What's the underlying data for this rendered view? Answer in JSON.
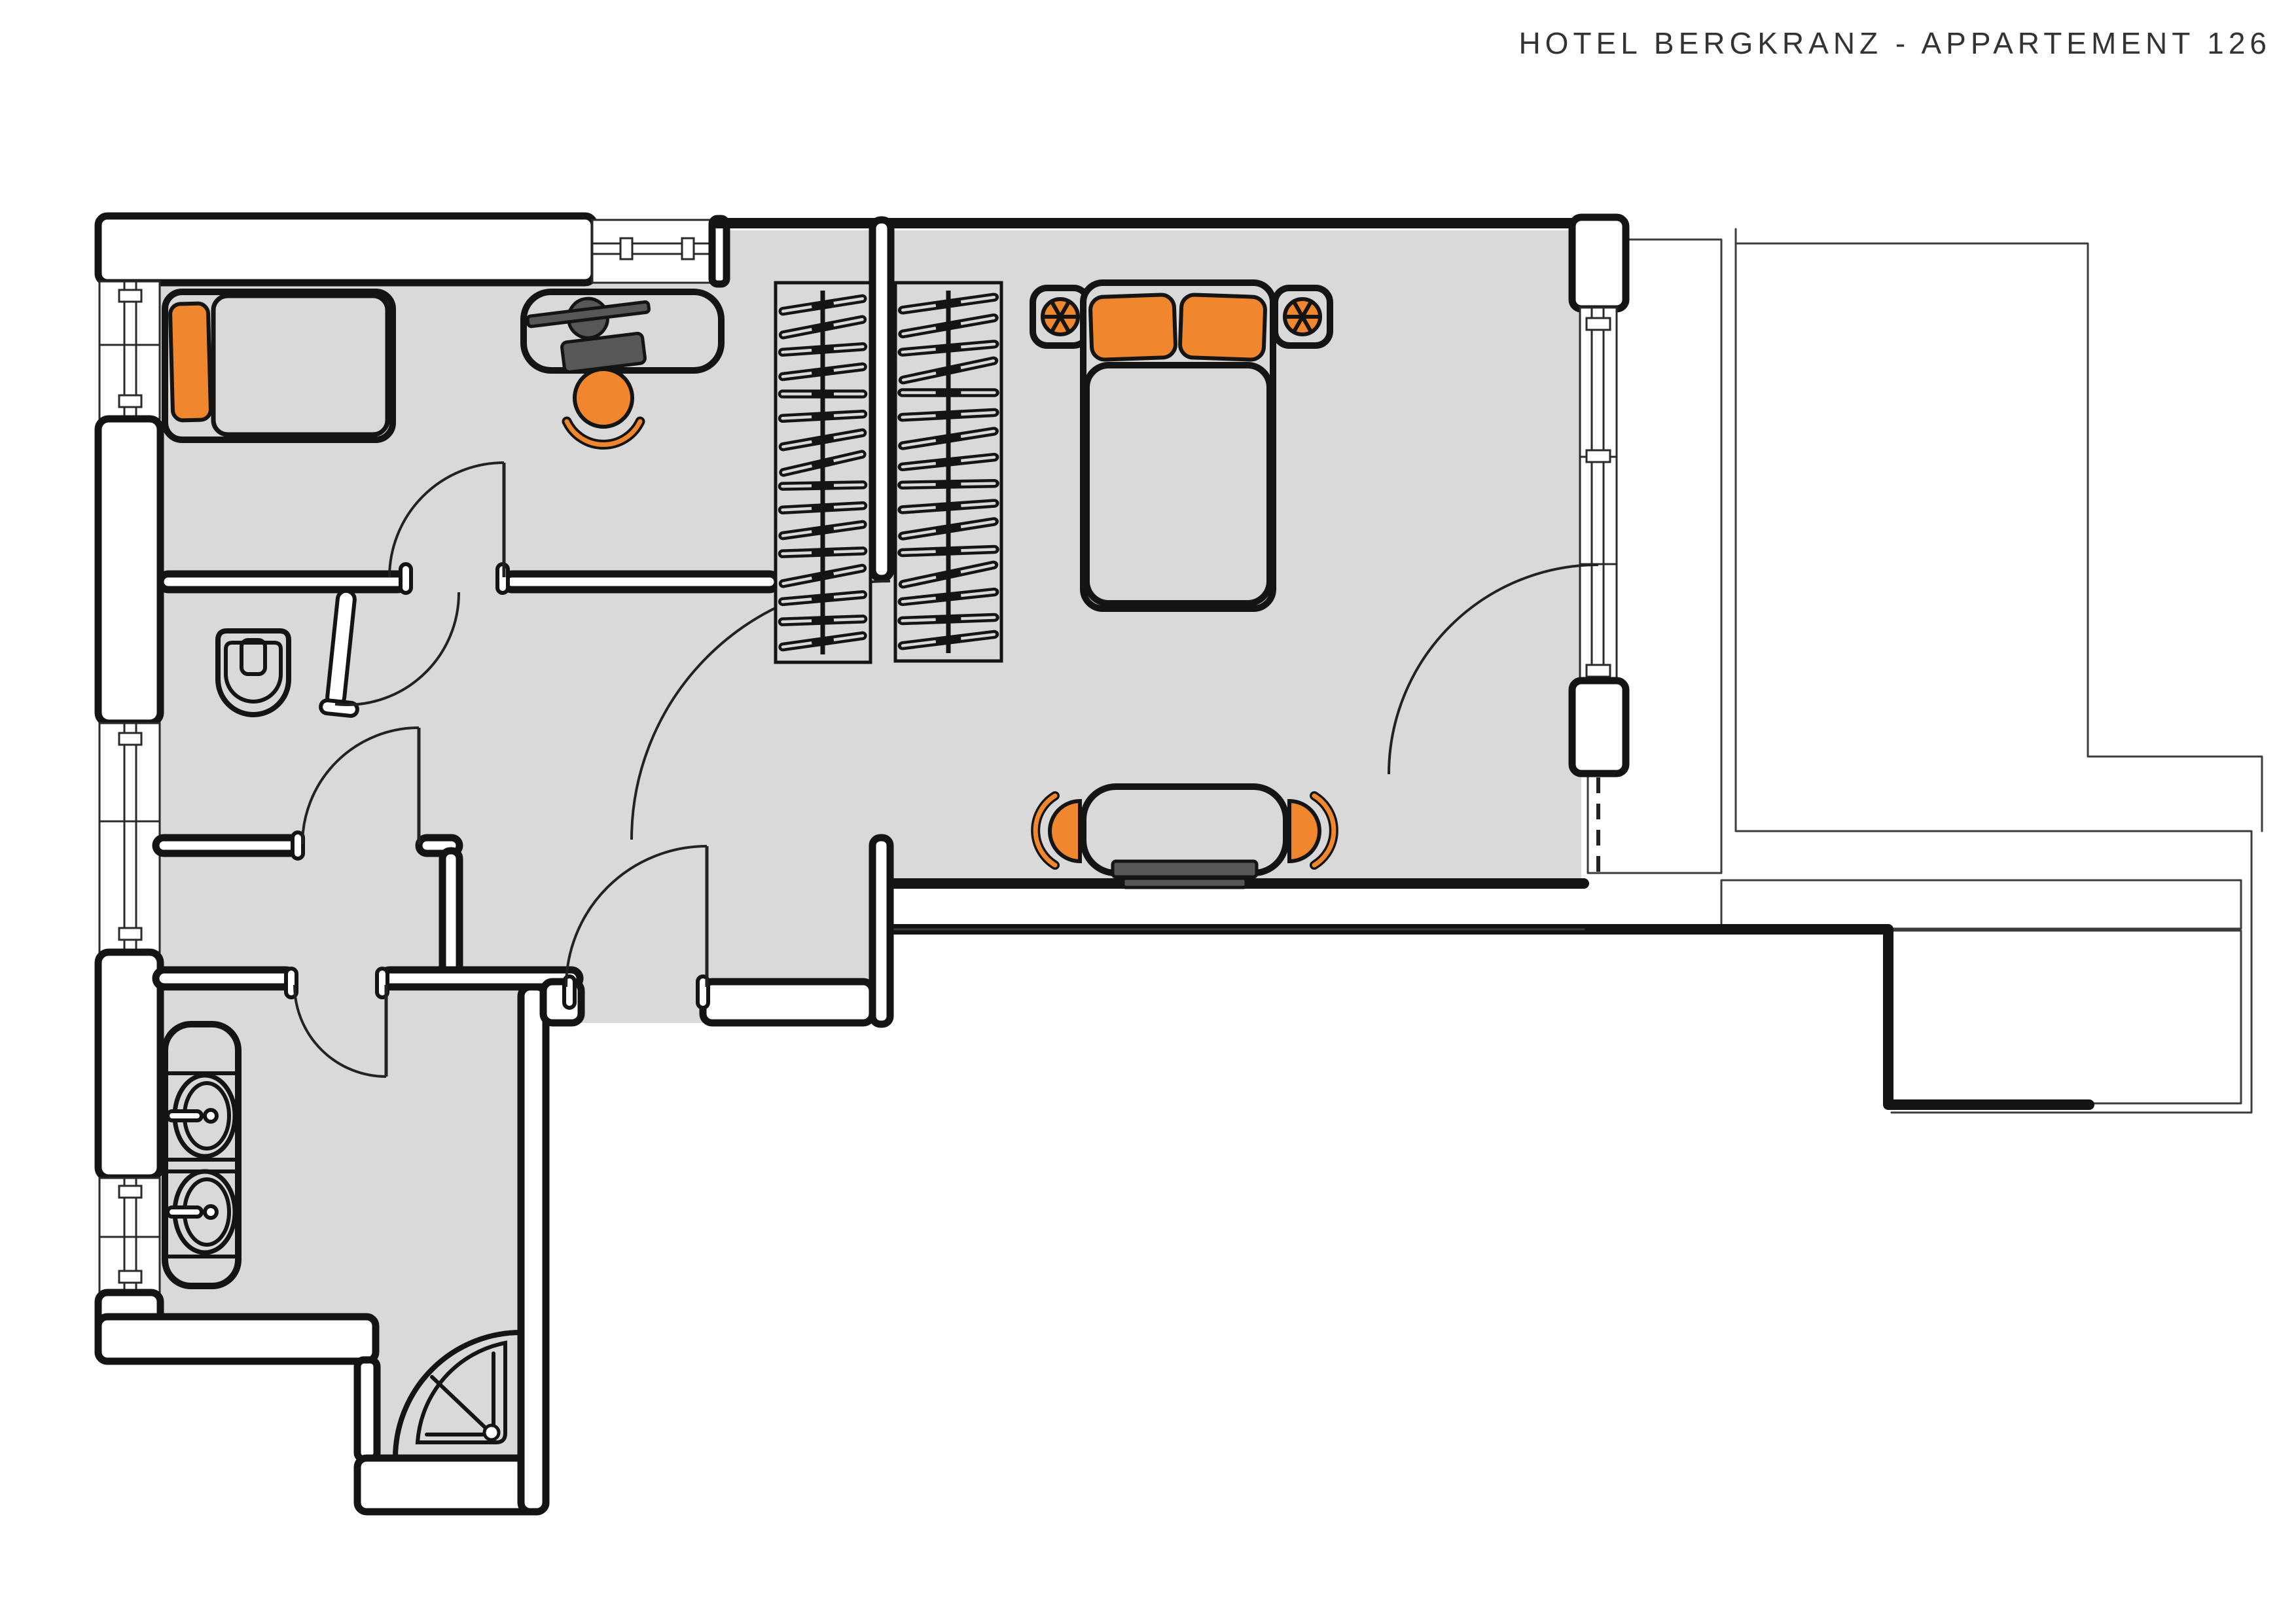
{
  "title": "HOTEL BERGKRANZ - APPARTEMENT 126",
  "colors": {
    "accent": "#F0862E",
    "floor": "#D9D9D9",
    "wall": "#FFFFFF",
    "line": "#141414",
    "dark": "#565759",
    "deck": "#8D8D8D"
  },
  "symbols": [
    "single-bed",
    "orange-pillow",
    "desk",
    "tv-on-desk",
    "desk-chair",
    "wardrobe-hangers-left",
    "wardrobe-hangers-right",
    "double-bed",
    "double-bed-pillows",
    "nightstand-left",
    "nightstand-right",
    "bedside-lamp-left",
    "bedside-lamp-right",
    "dining-table",
    "dining-chair-left",
    "dining-chair-right",
    "radiator",
    "toilet",
    "washbasin-top",
    "washbasin-bottom",
    "vanity-counter",
    "corner-shower",
    "balcony-decking",
    "balcony-railing",
    "door-single-room",
    "door-wc",
    "door-corridor",
    "door-bathroom",
    "door-entry",
    "door-bedroom",
    "door-balcony",
    "window-left-1",
    "window-left-2",
    "window-left-3",
    "window-top",
    "window-balcony"
  ]
}
